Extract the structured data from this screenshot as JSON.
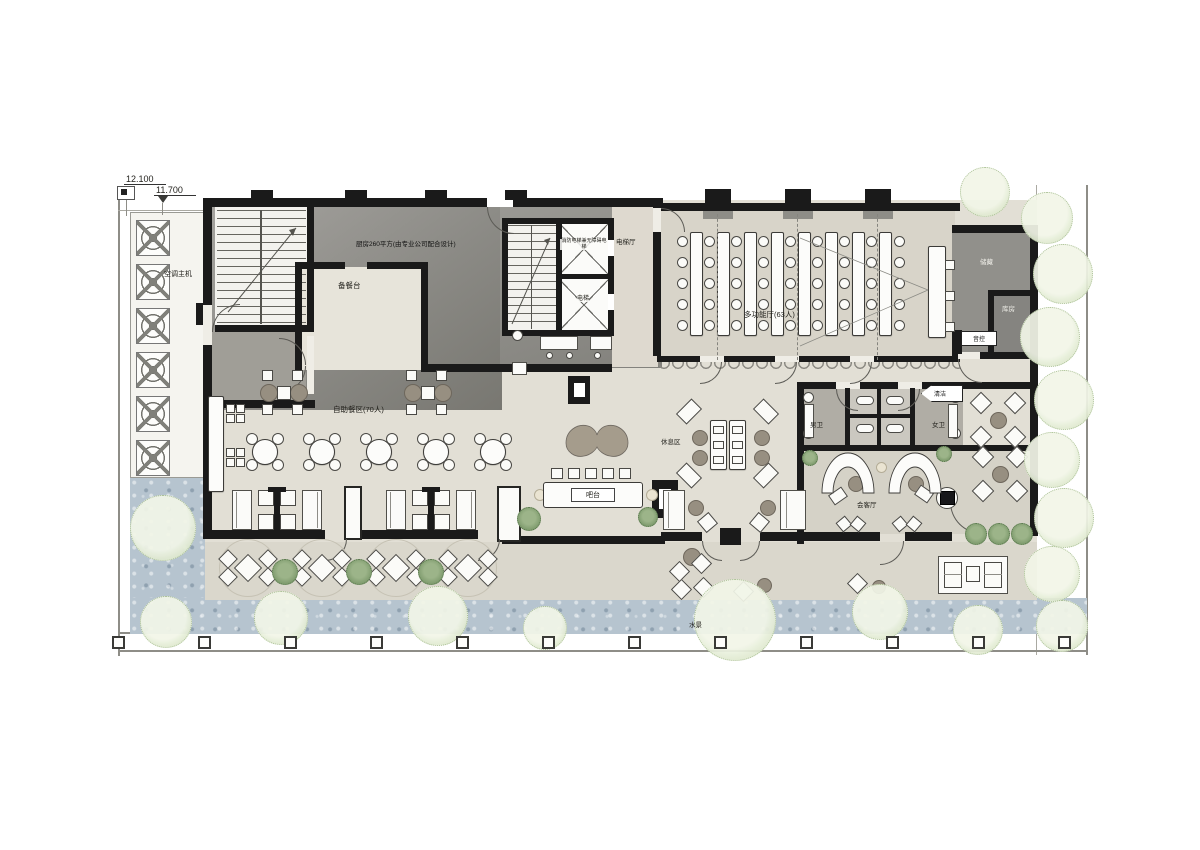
{
  "title": "酒店一层平面布置图",
  "levels": {
    "upper": "12.100",
    "lower": "11.700"
  },
  "labels": {
    "ac_unit": "空调主机",
    "kitchen": "厨房260平方(由专业公司配合设计)",
    "prep_counter": "备餐台",
    "fire_elevator": "消防电梯兼无障碍电梯",
    "elevator": "电梯",
    "elevator_hall": "电梯厅",
    "hall": "多功能厅(63人)",
    "storage": "储藏",
    "storeroom": "库房",
    "audio_control": "音控",
    "cleaning": "清洁",
    "mens_wc": "男卫",
    "womens_wc": "女卫",
    "reception": "会客厅",
    "lounge": "休息区",
    "buffet": "自助餐区(70人)",
    "bar": "吧台",
    "water_feature": "水景"
  },
  "palette": {
    "wall": "#1a1a1a",
    "floor": "#e2dfd5",
    "floor_dark": "#d8d4c9",
    "terrace": "#dad7cc",
    "water": "#b6c4cf",
    "wc_gray": "#b0ada5",
    "kitchen_gray": "#8f8e89",
    "tree_green": "#e9f0dd",
    "shrub_green": "#84a074",
    "furniture_border": "#3c3b38"
  }
}
